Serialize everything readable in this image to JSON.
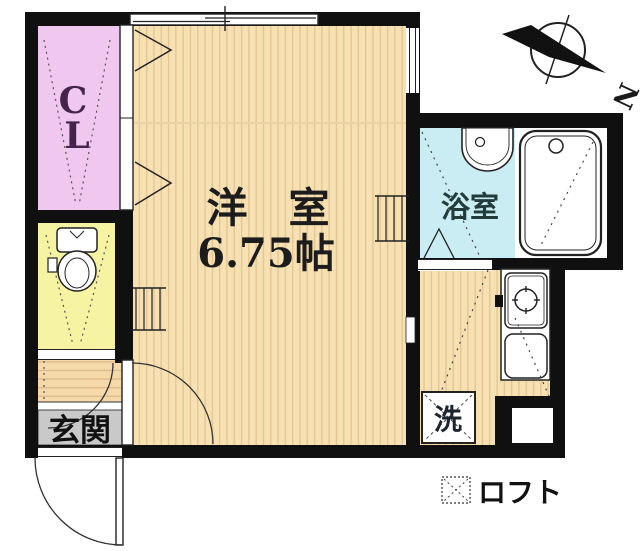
{
  "plan_title": "studio-apartment-floor-plan",
  "rooms": {
    "closet": {
      "label": "CL",
      "line1": "C",
      "line2": "L",
      "color": "#f0c8ef",
      "text_color": "#44244a"
    },
    "western_room": {
      "name": "洋　室",
      "size": "6.75帖",
      "color": "#f7e0b2",
      "text_color": "#1c1c1c"
    },
    "bathroom": {
      "label": "浴室",
      "color": "#c9edf2",
      "text_color": "#223c3c"
    },
    "toilet": {
      "color": "#f6f3a3"
    },
    "entrance": {
      "label": "玄関",
      "color": "#c9c9c9",
      "text_color": "#111111"
    },
    "laundry": {
      "label": "洗",
      "text_color": "#1c2430"
    }
  },
  "legend": {
    "loft_label": "ロフト"
  },
  "compass": {
    "north_label": "N"
  },
  "colors": {
    "wall": "#101010",
    "floor_stripe": "#e3c493",
    "outline": "#222222",
    "dash": "#444444"
  }
}
